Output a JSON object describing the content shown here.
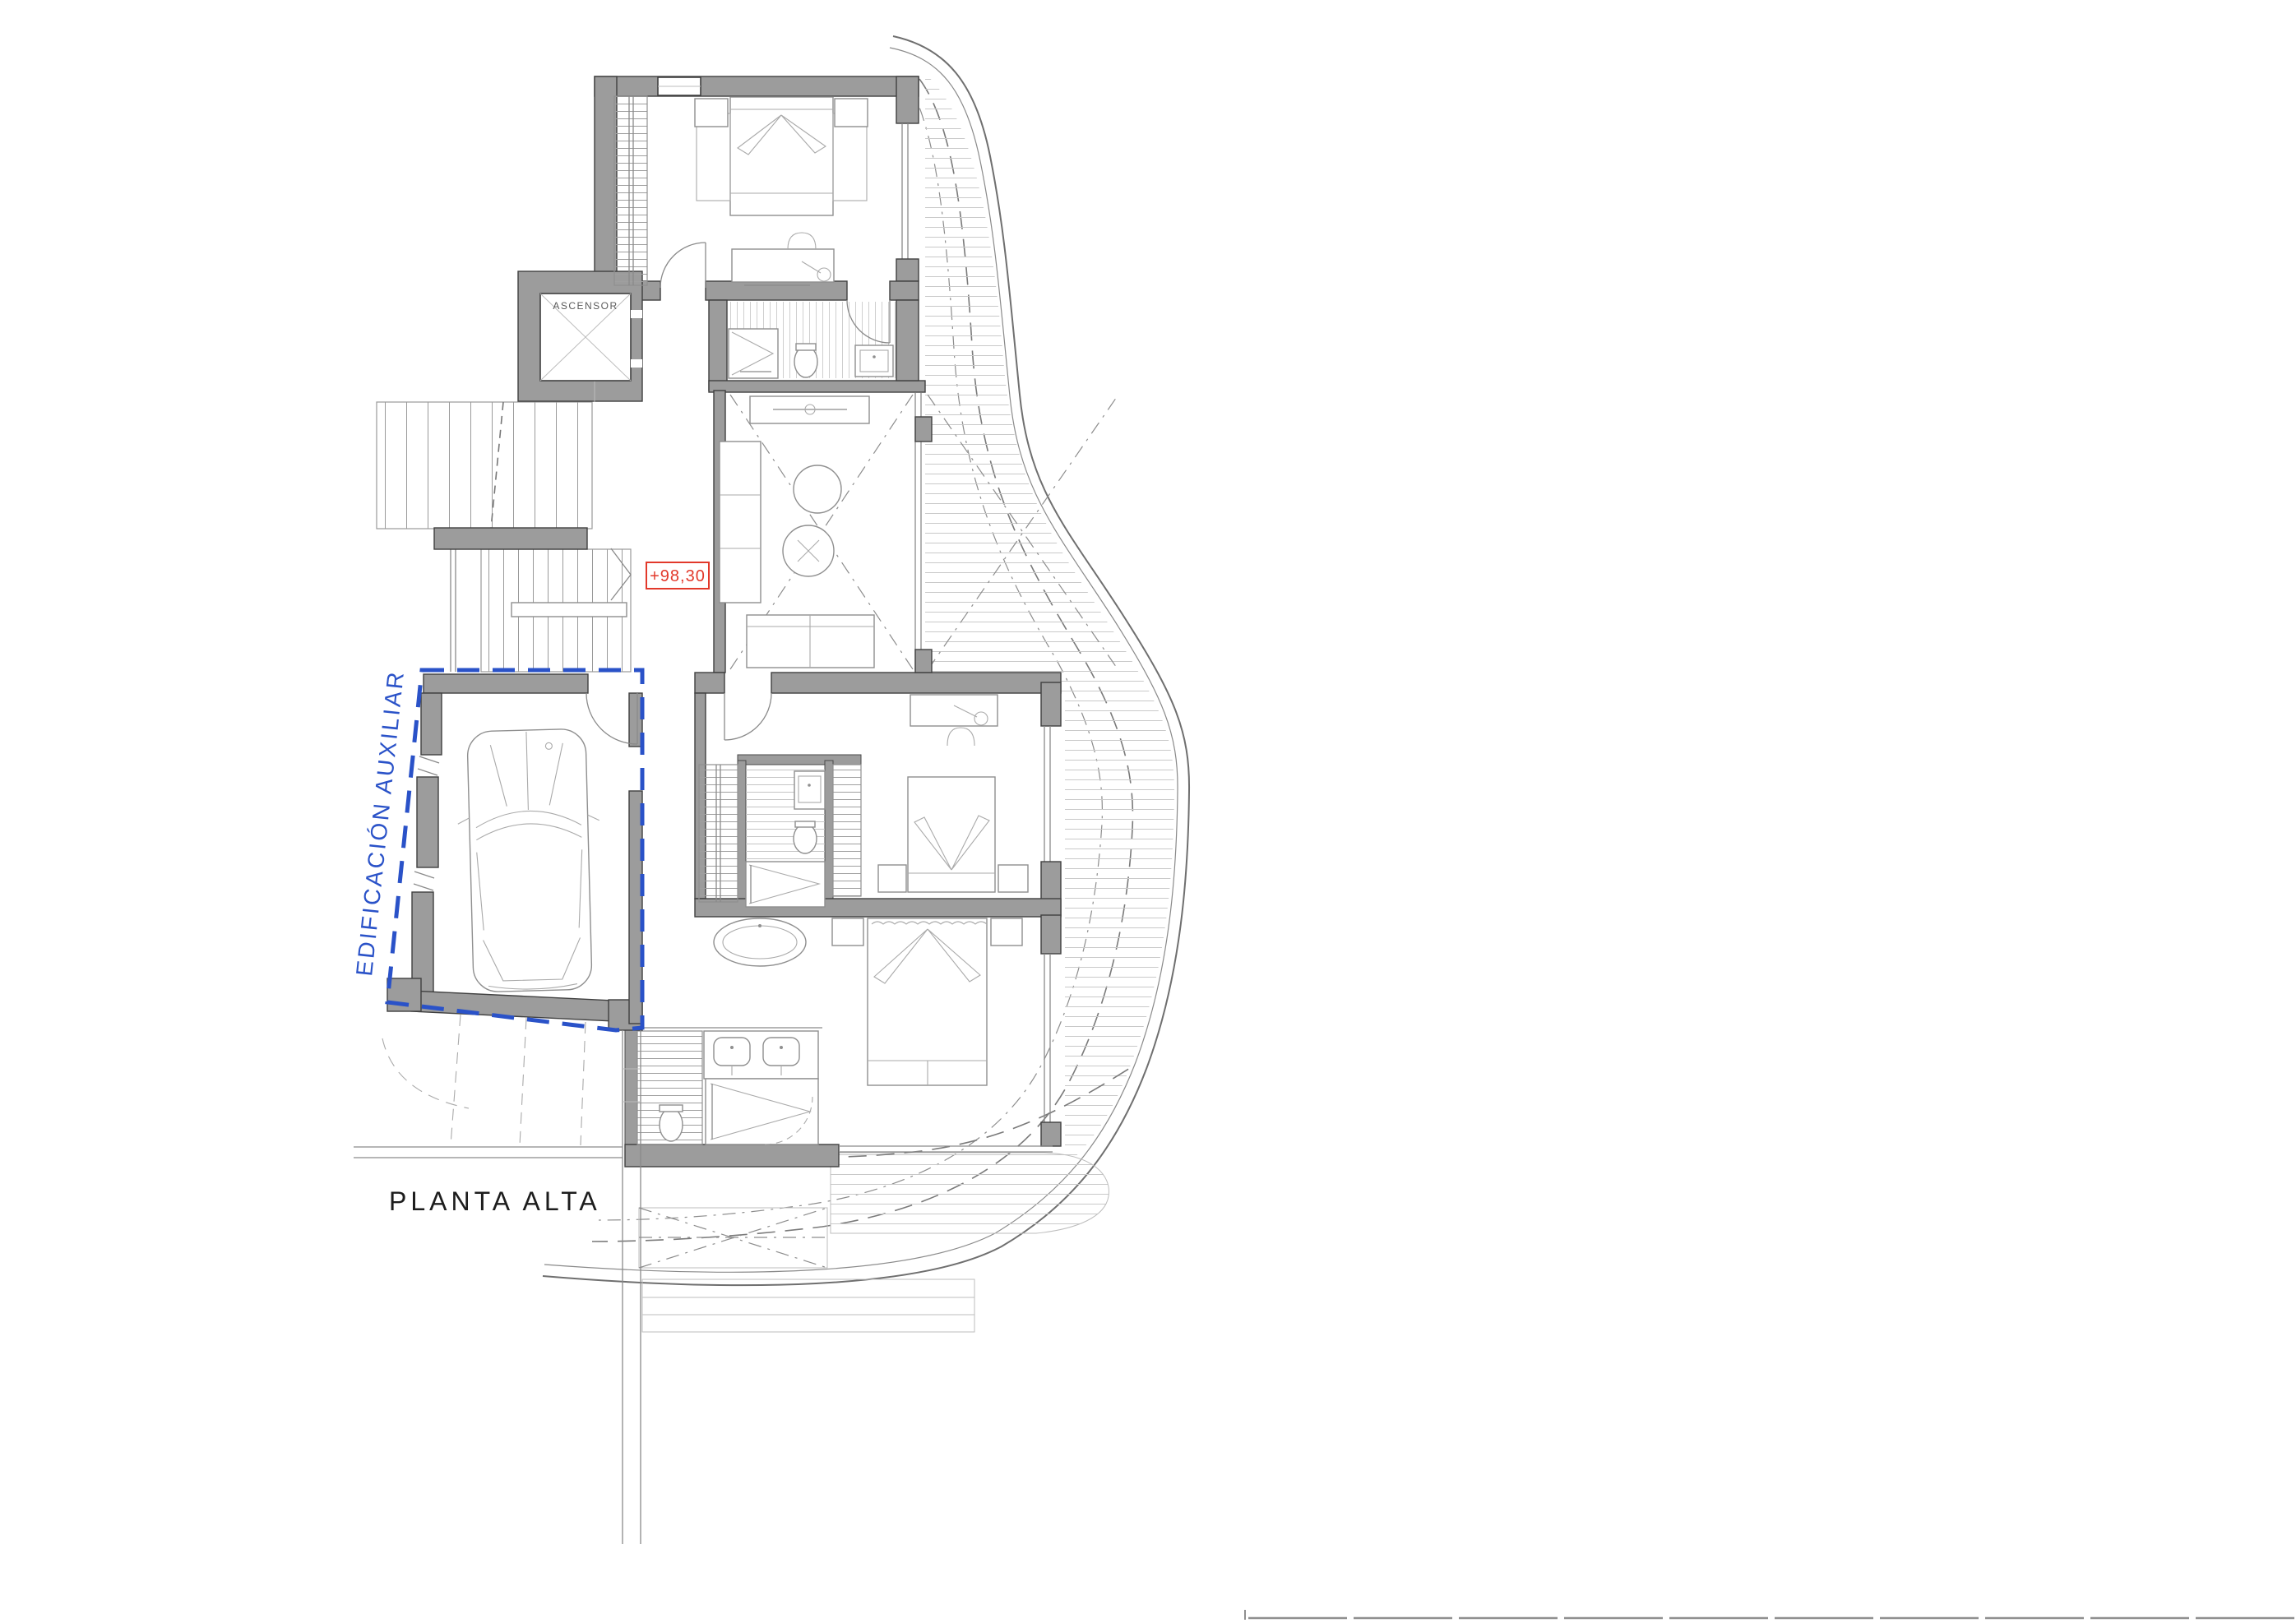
{
  "drawing": {
    "title": "PLANTA ALTA",
    "labels": {
      "elevator": "ASCENSOR",
      "level": "+98,30",
      "auxiliary_building": "EDIFICACIÓN AUXILIAR"
    },
    "colors": {
      "background": "#ffffff",
      "wall_fill": "#9c9c9c",
      "wall_edge": "#404040",
      "drawing_line": "#8a8a8a",
      "light_line": "#c6c6c6",
      "accent_blue": "#2a52c8",
      "annotation_red": "#e2392b",
      "title_text": "#1d1d1d"
    }
  }
}
